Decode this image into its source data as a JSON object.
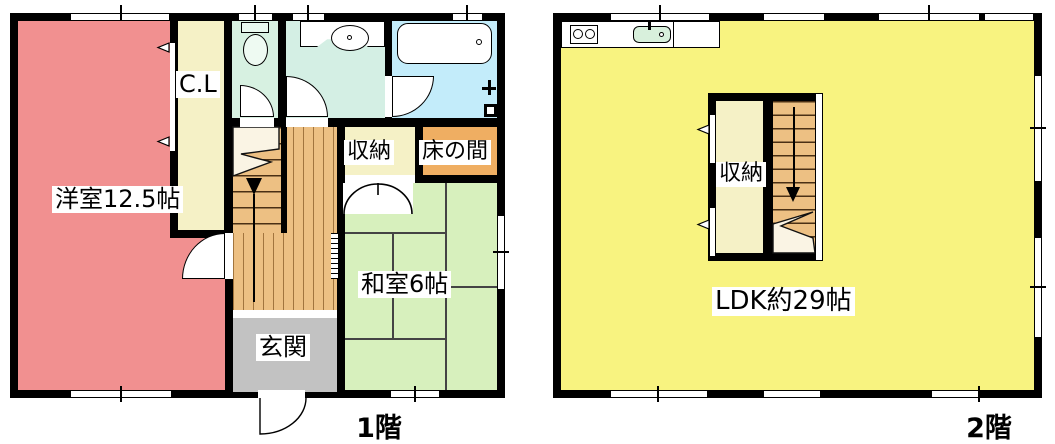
{
  "floor1": {
    "caption": "1階",
    "western_room": "洋室12.5帖",
    "closet": "C.L",
    "storage": "収納",
    "tokonoma": "床の間",
    "japanese_room": "和室6帖",
    "entrance": "玄関"
  },
  "floor2": {
    "caption": "2階",
    "storage": "収納",
    "ldk": "LDK約29帖"
  },
  "colors": {
    "wall": "#000000",
    "western_room_pink": "#f19090",
    "closet_cream": "#f5f1c6",
    "toilet_mint": "#d7f1e1",
    "washroom_mint": "#d4efe4",
    "bath_blue": "#c3ecfa",
    "tokonoma_orange": "#efae62",
    "tatami_green": "#d7f0bd",
    "wood_floor": "#edc083",
    "stair_break_cream": "#faf4e4",
    "entrance_gray": "#c2c2c2",
    "ldk_yellow": "#f8f380",
    "kitchen_sink_mint": "#d8f0dc",
    "fixture_white": "#ffffff"
  }
}
